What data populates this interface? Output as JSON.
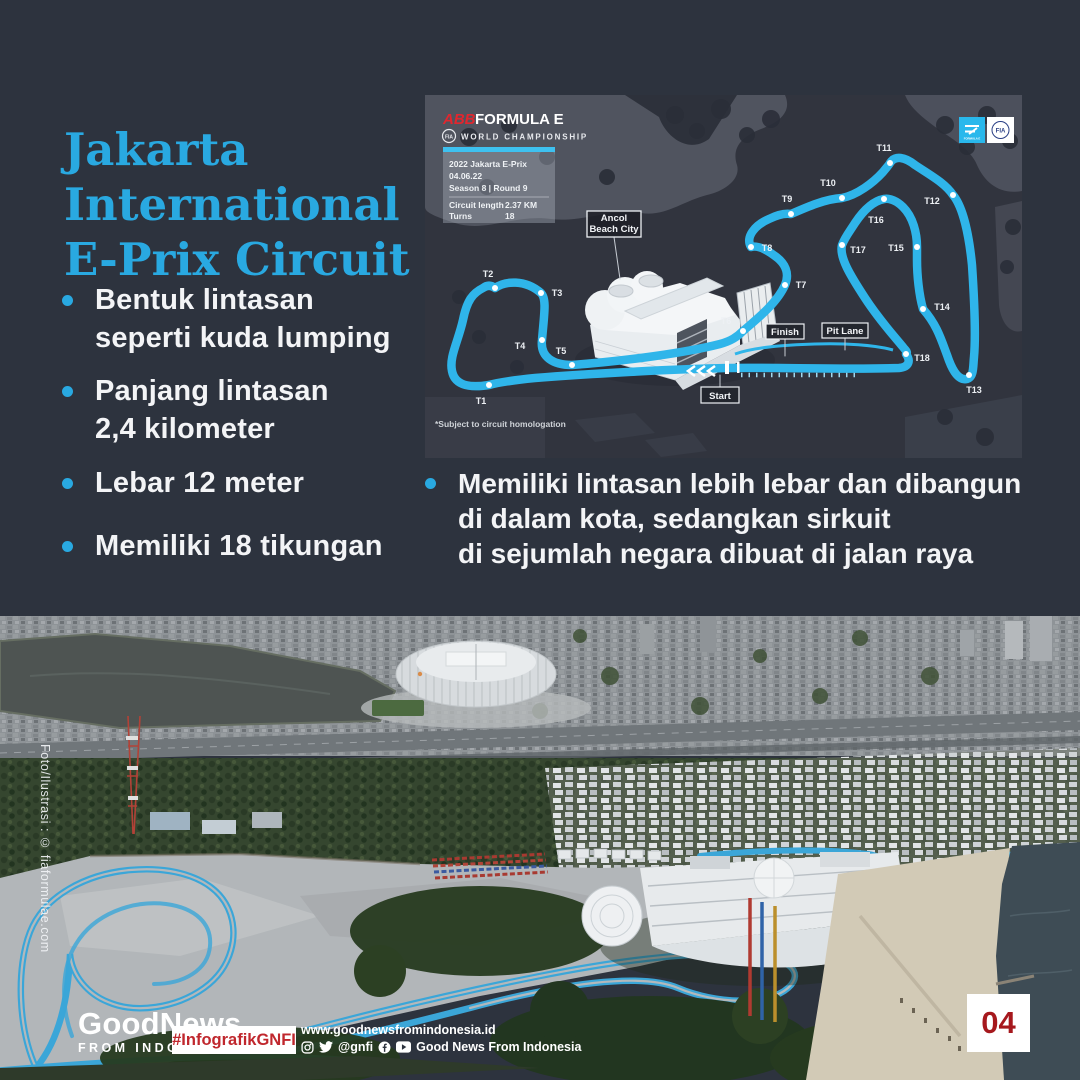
{
  "colors": {
    "background": "#2D333E",
    "accent_cyan": "#29A9E1",
    "track_blue": "#2FB5EA",
    "abb_red": "#E2262E",
    "hashtag_red": "#C0272D",
    "page_number_red": "#A6181D"
  },
  "title": {
    "lines": [
      "Jakarta",
      "International",
      "E-Prix Circuit"
    ]
  },
  "bullets_left": [
    {
      "lines": [
        "Bentuk lintasan",
        "seperti kuda lumping"
      ]
    },
    {
      "lines": [
        "Panjang lintasan",
        "2,4 kilometer"
      ]
    },
    {
      "lines": [
        "Lebar 12 meter"
      ]
    },
    {
      "lines": [
        "Memiliki 18 tikungan"
      ]
    }
  ],
  "bullet_right": {
    "lines": [
      "Memiliki lintasan lebih lebar dan dibangun",
      "di dalam kota, sedangkan sirkuit",
      "di sejumlah negara dibuat di jalan raya"
    ]
  },
  "map": {
    "brand": {
      "abb": "ABB",
      "formula_e": "FORMULA E",
      "fia": "FIA",
      "world_championship": "WORLD CHAMPIONSHIP"
    },
    "badges": {
      "fe_box": "FORMULA E",
      "fia_box": "FIA"
    },
    "event_card": {
      "header_line1": "2022 Jakarta E-Prix",
      "header_line2": "04.06.22",
      "header_line3": "Season 8 | Round 9",
      "rows": [
        {
          "label": "Circuit length",
          "value": "2.37 KM"
        },
        {
          "label": "Turns",
          "value": "18"
        }
      ]
    },
    "venue_label": {
      "lines": [
        "Ancol",
        "Beach City"
      ]
    },
    "flags": {
      "finish": "Finish",
      "pit_lane": "Pit Lane",
      "start": "Start"
    },
    "footnote": "*Subject to circuit homologation",
    "turns": [
      {
        "id": "T1",
        "x": 64,
        "y": 290,
        "lx": 56,
        "ly": 309
      },
      {
        "id": "T2",
        "x": 70,
        "y": 193,
        "lx": 63,
        "ly": 182
      },
      {
        "id": "T3",
        "x": 116,
        "y": 198,
        "lx": 132,
        "ly": 201
      },
      {
        "id": "T4",
        "x": 117,
        "y": 245,
        "lx": 95,
        "ly": 254
      },
      {
        "id": "T5",
        "x": 147,
        "y": 270,
        "lx": 136,
        "ly": 259
      },
      {
        "id": "T6",
        "x": 318,
        "y": 236,
        "lx": 301,
        "ly": 229
      },
      {
        "id": "T7",
        "x": 360,
        "y": 190,
        "lx": 376,
        "ly": 193
      },
      {
        "id": "T8",
        "x": 326,
        "y": 152,
        "lx": 342,
        "ly": 156
      },
      {
        "id": "T9",
        "x": 366,
        "y": 119,
        "lx": 362,
        "ly": 107
      },
      {
        "id": "T10",
        "x": 417,
        "y": 103,
        "lx": 403,
        "ly": 91
      },
      {
        "id": "T11",
        "x": 465,
        "y": 68,
        "lx": 459,
        "ly": 56
      },
      {
        "id": "T12",
        "x": 528,
        "y": 100,
        "lx": 507,
        "ly": 109
      },
      {
        "id": "T13",
        "x": 544,
        "y": 280,
        "lx": 549,
        "ly": 298
      },
      {
        "id": "T14",
        "x": 498,
        "y": 214,
        "lx": 517,
        "ly": 215
      },
      {
        "id": "T15",
        "x": 492,
        "y": 152,
        "lx": 471,
        "ly": 156
      },
      {
        "id": "T16",
        "x": 459,
        "y": 104,
        "lx": 451,
        "ly": 128
      },
      {
        "id": "T17",
        "x": 417,
        "y": 150,
        "lx": 433,
        "ly": 158
      },
      {
        "id": "T18",
        "x": 481,
        "y": 259,
        "lx": 497,
        "ly": 266
      }
    ]
  },
  "photo": {
    "credit": "Foto/Ilustrasi : © fiaformulae.com"
  },
  "footer": {
    "logo_top": "GoodNews",
    "logo_bottom": "FROM INDONESIA",
    "hashtag": "#InfografikGNFI",
    "website": "www.goodnewsfromindonesia.id",
    "social_handle": "@gnfi",
    "social_name": "Good News From Indonesia",
    "page_number": "04"
  }
}
